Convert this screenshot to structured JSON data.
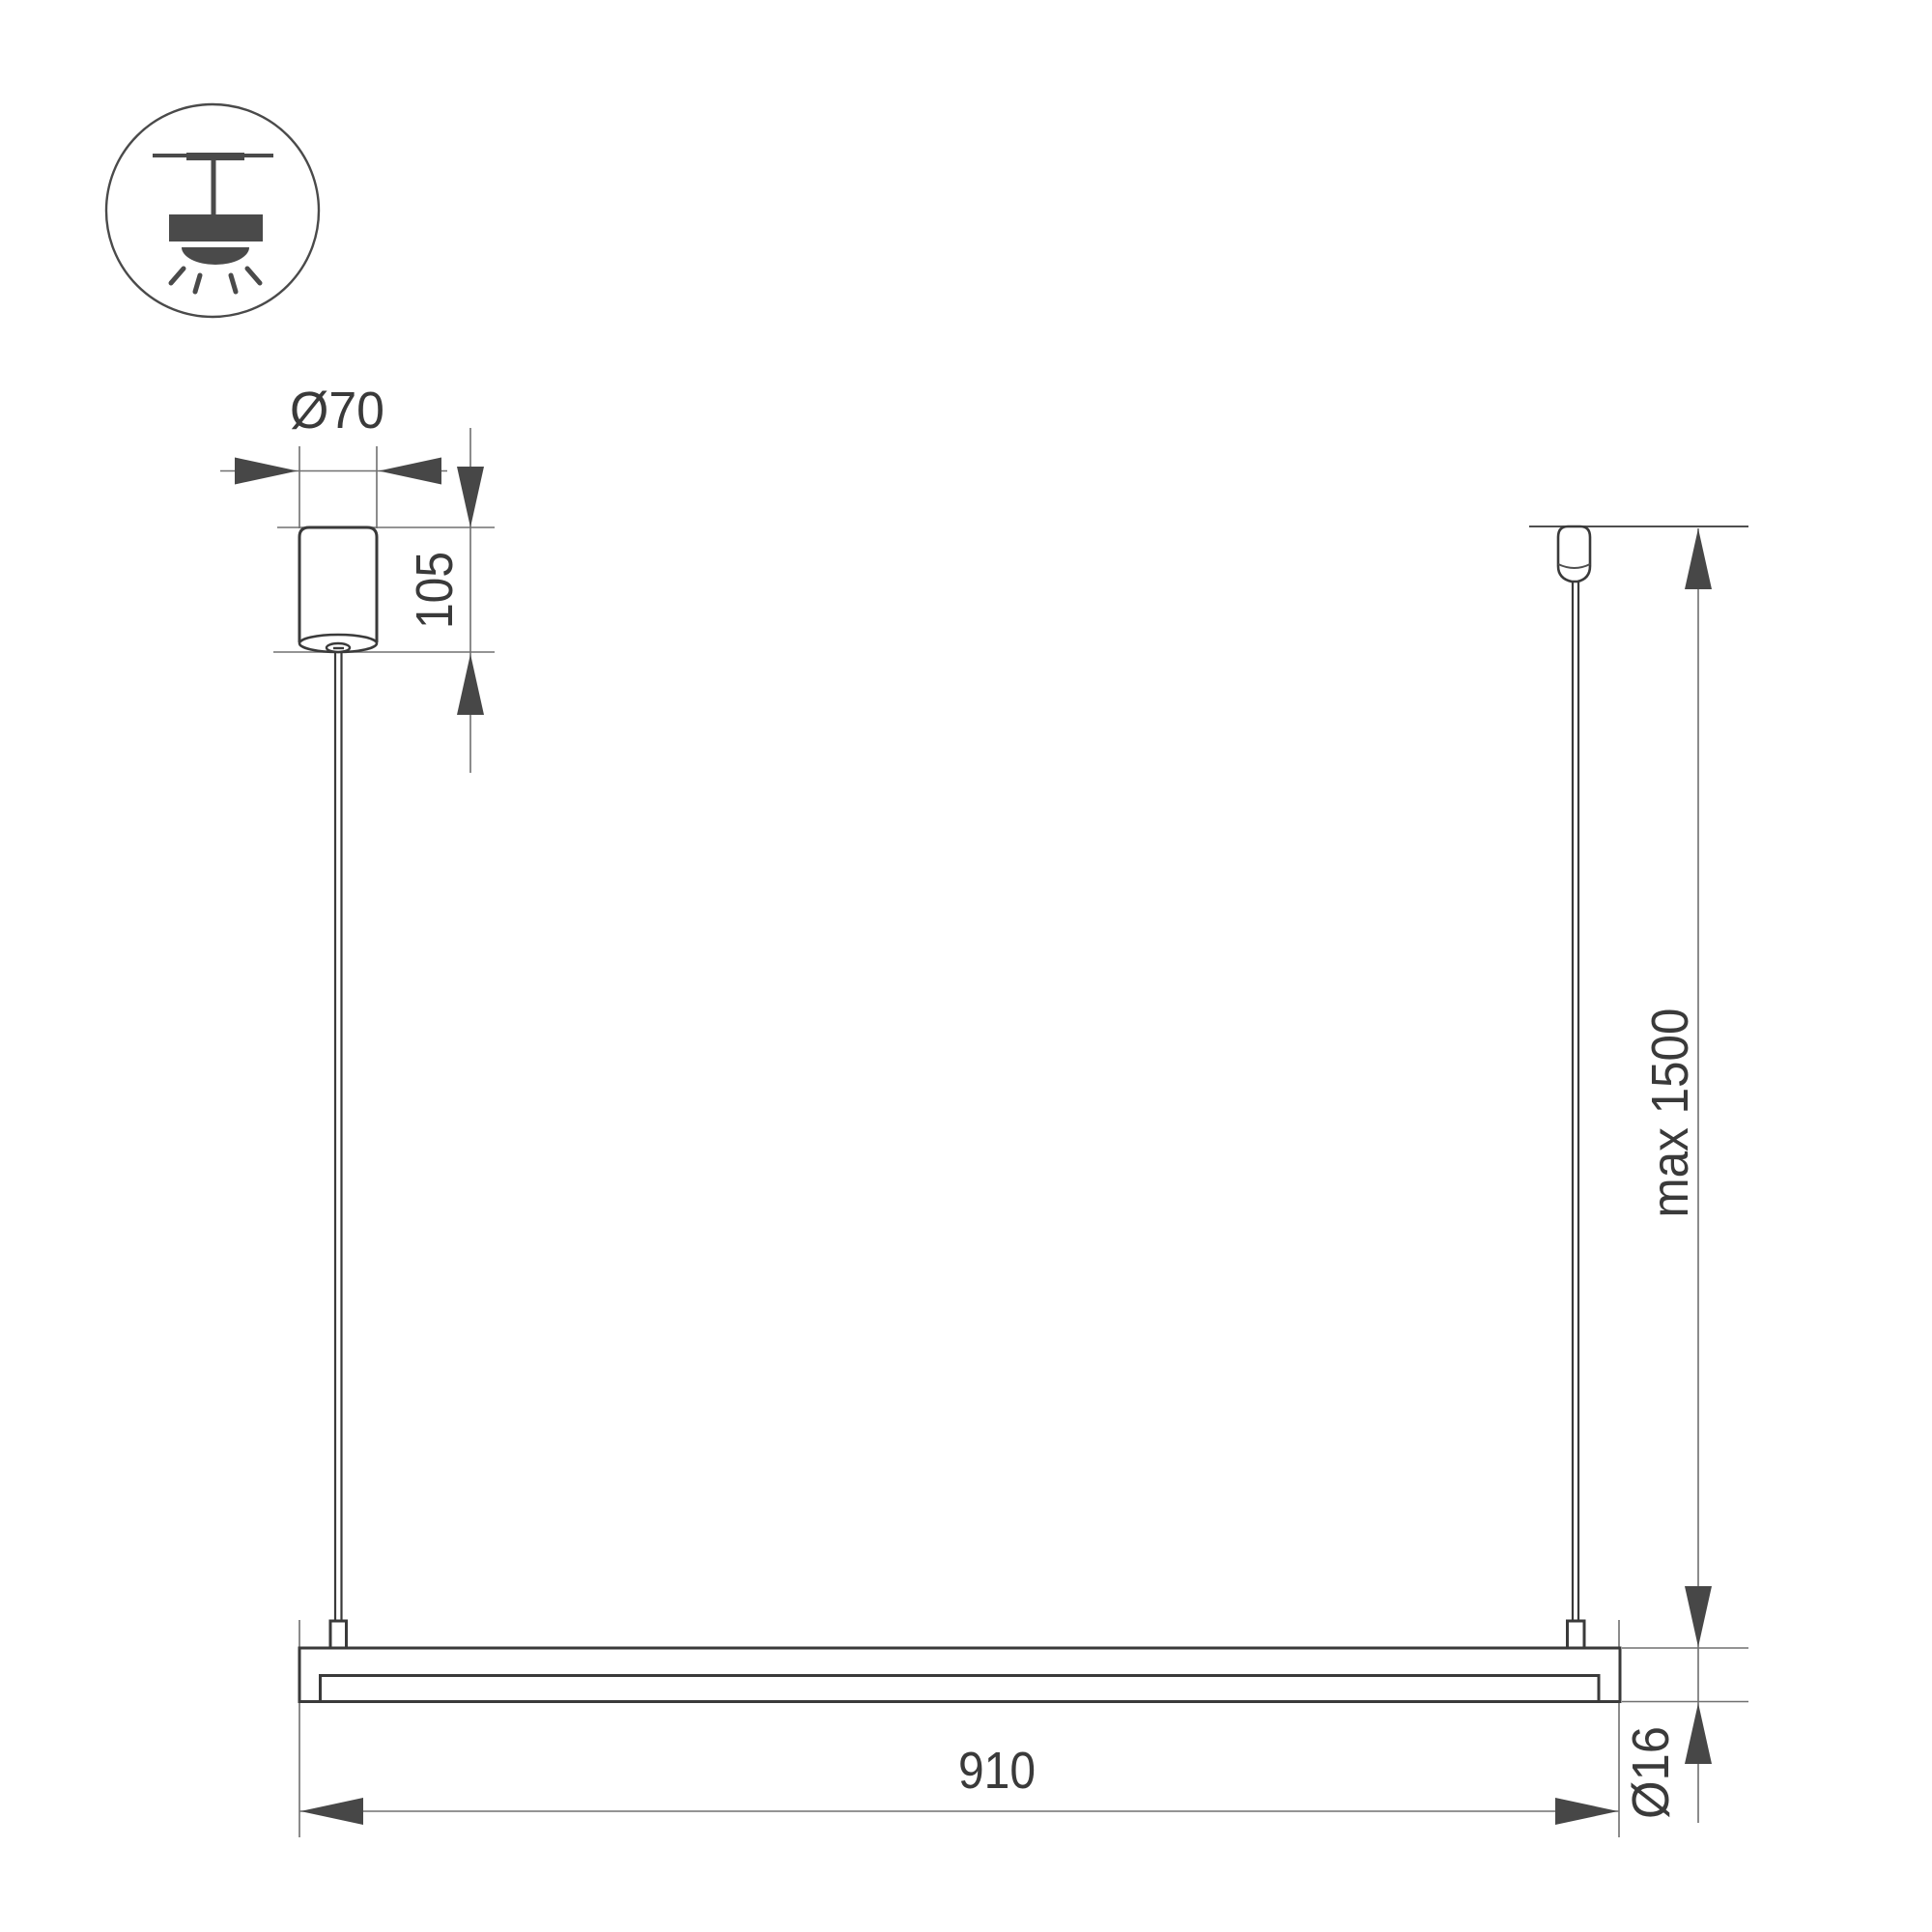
{
  "drawing": {
    "kind": "pendant-luminaire-dimension-drawing",
    "icon": {
      "name": "pendant-ceiling-light-icon"
    },
    "dimensions": {
      "canopy_diameter": "Ø70",
      "canopy_height": "105",
      "max_suspension_height": "max 1500",
      "fixture_length": "910",
      "tube_diameter": "Ø16"
    },
    "colors": {
      "background": "#ffffff",
      "ink": "#3a3a3a",
      "icon_ink": "#4a4a4a",
      "thin_line": "#707070",
      "mid_line": "#4f4f4f",
      "arrow": "#474747"
    }
  }
}
